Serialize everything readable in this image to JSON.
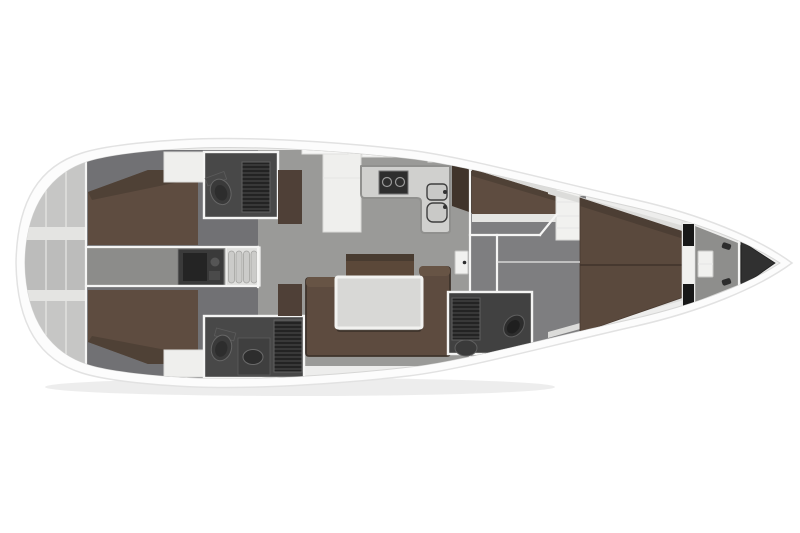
{
  "diagram": {
    "kind": "yacht-interior-floor-plan",
    "orientation": "bow-right",
    "areas": [
      "transom-storage",
      "aft-cabin-port",
      "aft-cabin-starboard",
      "aft-head-port",
      "aft-head-starboard",
      "engine-compartment",
      "companionway-steps",
      "saloon",
      "galley",
      "owner-cabin",
      "forward-head",
      "v-berth",
      "anchor-locker",
      "bow-tip"
    ]
  },
  "palette": {
    "background": "#ffffff",
    "hull": "#fcfcfc",
    "hullStroke": "#e2e2e2",
    "deck": "#ededec",
    "deckStroke": "#d6d6d5",
    "transom": "#c6c6c5",
    "transomShade": "#bcbcbb",
    "transomShelf": "#e4e4e2",
    "floorCabin": "#717174",
    "floorCorridor": "#8c8c8a",
    "floorSalon": "#9a9a98",
    "floorOwner": "#7e7e80",
    "floorBow": "#8e8e8c",
    "berth": "#5e4c40",
    "berthShade": "#4f4136",
    "vberth": "#5a493d",
    "vberthShade": "#4c3e34",
    "ledge": "#dcdcda",
    "sofa": "#5d4b3f",
    "sofaEdge": "#3e332b",
    "sofaArm": "#675445",
    "sideboard": "#5b4839",
    "sideboardTop": "#483b30",
    "counterBrown": "#4f4037",
    "wardrobe": "#40342b",
    "table": "#d8d8d6",
    "tableEdge": "#f2f2f0",
    "galleyCounter": "#d0d0ce",
    "galleyEdge": "#90908e",
    "cabinetWhite": "#efefed",
    "stepsBase": "#dfdfdd",
    "stepBar": "#cbcbc9",
    "engine": "#3a3a3a",
    "engineDark": "#242424",
    "headFloor": "#484848",
    "headFloorFwd": "#414141",
    "grateDark": "#272727",
    "fixture": "#3a3a3a",
    "fixtureDark": "#2d2d2d",
    "fixtureStroke": "#696969",
    "sinkSteel": "#c9c9c7",
    "stove": "#2e2e2e",
    "bowTriangle": "#303030",
    "blackLocker": "#181818",
    "whiteBox": "#f1f1ef",
    "shadow": "rgba(0,0,0,0.07)"
  }
}
